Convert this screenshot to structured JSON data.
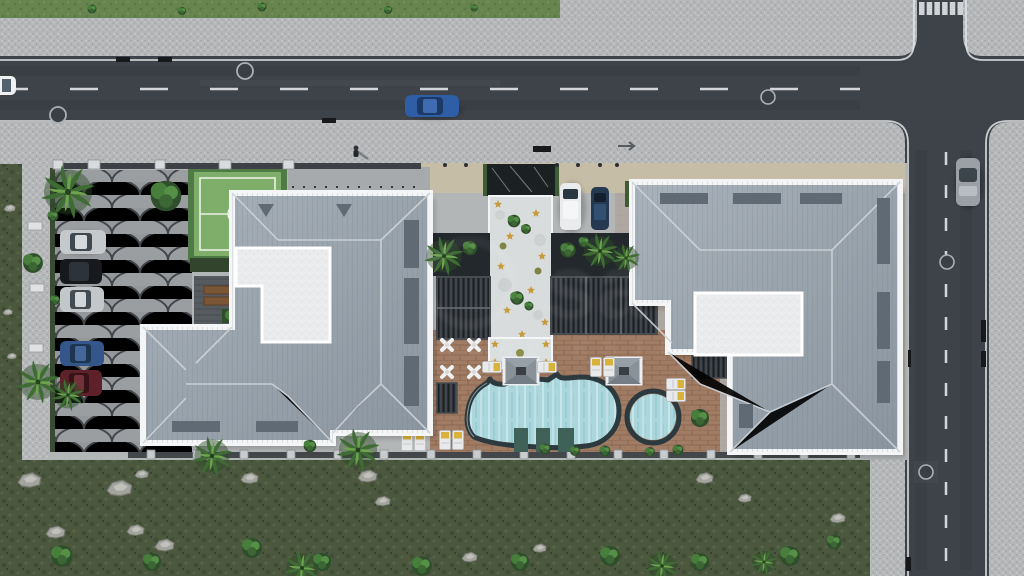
{
  "meta": {
    "title": "Aerial 3D site-plan render of a residential complex",
    "view": "top-down drone view",
    "style": "photorealistic architectural visualization"
  },
  "watermark": {
    "primary": "sa",
    "secondary": "REAL ESTATE"
  },
  "palette": {
    "asphalt": "#3e4349",
    "sidewalk": "#b5b7b9",
    "grass_top": "#67844f",
    "grass_wild": "#4b583e",
    "roof": "#9aa3ac",
    "roof_ridge": "#cdd3d9",
    "parapet_white": "#f3f5f6",
    "flat_roof": "#e9ebec",
    "pool_water": "#abd6dc",
    "pool_rim": "#2c3a3f",
    "pool_deck_brick": "#a17c64",
    "scallop_paving": "#94989b",
    "walkway": "#d9dcdc",
    "entrance_marble": "#1b2023",
    "court_green": "#7fae6a",
    "pergola": "#2c3034",
    "hedge_green": "#3f5c35",
    "star_gold": "#c79b3b",
    "lane_marking": "#e3e6e8"
  },
  "site": {
    "buildings": [
      {
        "id": "block-west",
        "shape": "L-shaped",
        "roof": "grey standing-seam hip roof, white parapet",
        "features": [
          "white flat-roof court",
          "skylight strips",
          "roof vents"
        ]
      },
      {
        "id": "block-east",
        "shape": "rectangular with notch court",
        "roof": "grey standing-seam hip roof, white parapet",
        "features": [
          "white flat-roof court",
          "skylight strips"
        ]
      }
    ],
    "amenities": [
      "free-form swimming pool",
      "round kids pool",
      "sun deck with loungers",
      "two gazebos",
      "timber pergolas",
      "central white walkway with gold stars",
      "green sports court",
      "fish-scale paved parking",
      "dark marble entrance path"
    ],
    "landscape": [
      "palm trees",
      "round bushes",
      "hedges",
      "wild grass with rocks",
      "boundary wall with post caps"
    ]
  },
  "vehicles": {
    "on_main_road": [
      {
        "color": "blue"
      },
      {
        "color": "white",
        "note": "clipped at left edge"
      }
    ],
    "on_side_road": [
      {
        "color": "silver",
        "state": "parked"
      }
    ],
    "parked_west_lot": [
      "silver",
      "black",
      "silver",
      "blue",
      "dark red"
    ],
    "parked_north_drive": [
      "white",
      "navy blue"
    ]
  },
  "roads": {
    "main_road": {
      "orientation": "horizontal",
      "marking": "white dashed centre line + solid edge lines",
      "manholes": 3,
      "drains": "black kerb drains"
    },
    "side_road": {
      "orientation": "vertical",
      "marking": "white dashed centre line",
      "crosswalk": "zebra on north leg",
      "manholes": 2
    },
    "intersection": "four-way with rounded kerbs"
  },
  "people": [
    {
      "location": "north sidewalk",
      "count": 1
    }
  ]
}
